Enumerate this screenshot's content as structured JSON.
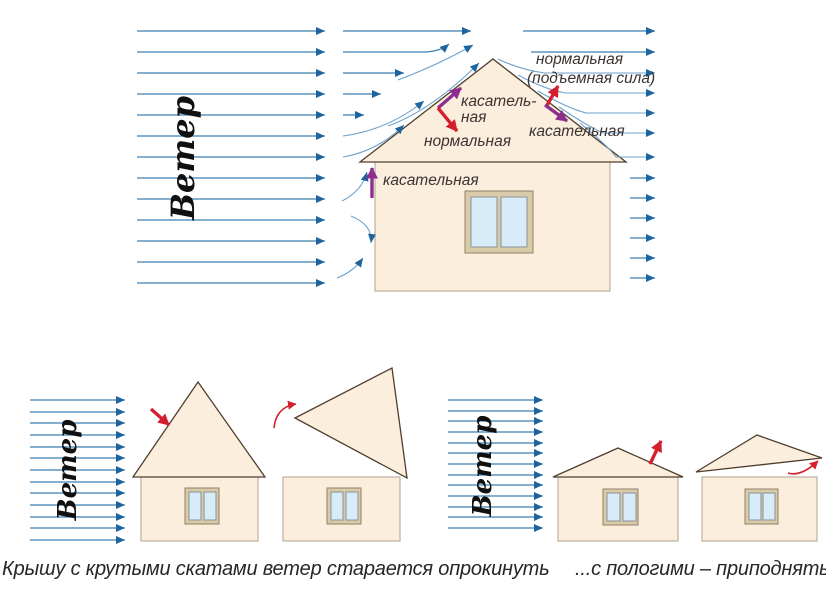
{
  "wind_label": "Ветер",
  "top_diagram": {
    "labels": {
      "tangential_left_line1": "касатель-",
      "tangential_left_line2": "ная",
      "normal_left": "нормальная",
      "normal_right_line1": "нормальная",
      "normal_right_line2": "(подъемная сила)",
      "tangential_right": "касательная",
      "tangential_wall": "касательная"
    }
  },
  "captions": {
    "steep": "Крышу с крутыми скатами ветер старается опрокинуть",
    "shallow": "...с пологими – приподнять"
  },
  "colors": {
    "stream": "#3c7fb1",
    "stream_dark": "#1e659f",
    "stream_curve": "#6fa3cc",
    "red": "#d31f2e",
    "purple": "#8e2d8e",
    "house_fill": "#fbeedd",
    "wall_stroke": "#b1a28c",
    "roof_stroke": "#503f2e",
    "win_frame": "#d9caa8",
    "win_frame_stroke": "#8f8068",
    "pane": "#d7ebf8",
    "pane_stroke": "#8a9199",
    "label_text": "#3b3330",
    "caption_text": "#272727",
    "wind_text": "#101010"
  }
}
